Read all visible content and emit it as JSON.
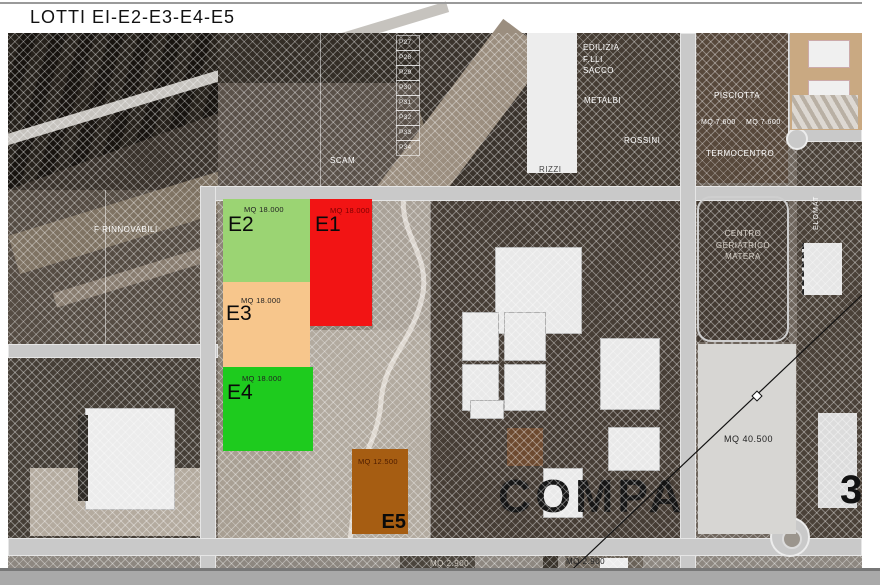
{
  "page": {
    "title": "LOTTI EI-E2-E3-E4-E5"
  },
  "lots": [
    {
      "id": "E1",
      "name": "E1",
      "area_label": "MQ 18.000",
      "color": "#f21414"
    },
    {
      "id": "E2",
      "name": "E2",
      "area_label": "MQ 18.000",
      "color": "#9bd473"
    },
    {
      "id": "E3",
      "name": "E3",
      "area_label": "MQ 18.000",
      "color": "#f7c68c"
    },
    {
      "id": "E4",
      "name": "E4",
      "area_label": "MQ 18.000",
      "color": "#1ecb1e"
    },
    {
      "id": "E5",
      "name": "E5",
      "area_label": "MQ 12.500",
      "color": "#a65d12"
    }
  ],
  "map_labels": {
    "scam": "SCAM",
    "rizzi": "RIZZI",
    "f_rinnovabili": "F RINNOVABILI",
    "edilizia_flli_sacco": "EDILIZIA\nF.LLI\nSACCO",
    "metalbi": "METALBI",
    "rossini": "ROSSINI",
    "pisciotta": "PISCIOTTA",
    "mq_7600_a": "MQ 7.600",
    "mq_7600_b": "MQ 7.600",
    "termocentro": "TERMOCENTRO",
    "centro_geriatrico": "CENTRO\nGERIATRICO\nMATERA",
    "elomat": "ELOMAT",
    "mq_40500": "MQ 40.500",
    "mq_2900_a": "MQ 2.900",
    "mq_2900_b": "MQ 2.900",
    "comp_photo_text": "COMPA",
    "big_3": "3",
    "small_lots": [
      "P27",
      "P28",
      "P29",
      "P30",
      "P31",
      "P32",
      "P33",
      "P34"
    ]
  }
}
